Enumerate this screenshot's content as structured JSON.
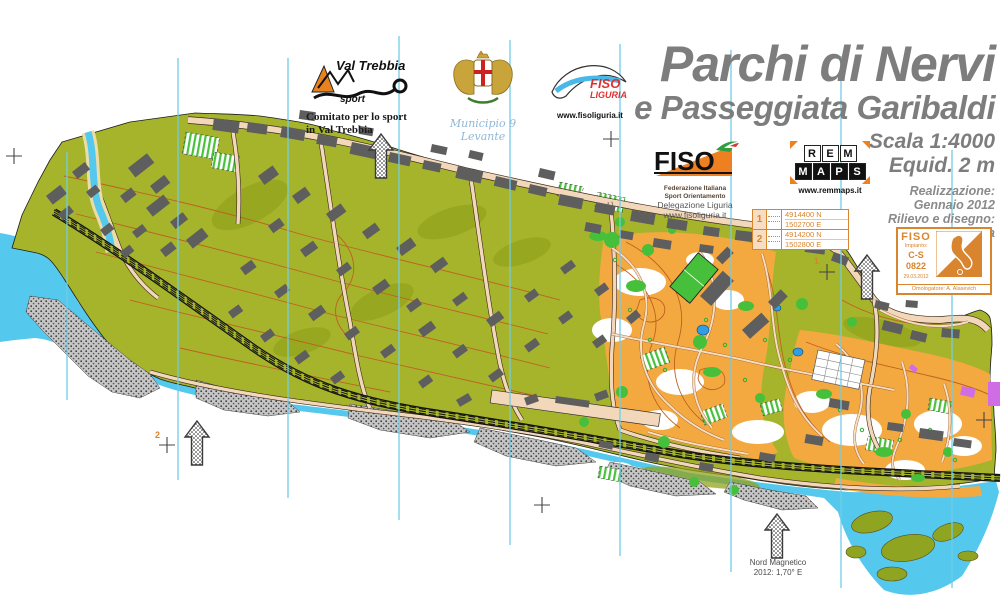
{
  "title": {
    "line1": "Parchi di Nervi",
    "line2": "e Passeggiata Garibaldi",
    "scale": "Scala 1:4000",
    "equidistance": "Equid. 2 m"
  },
  "credits": {
    "line1": "Realizzazione:",
    "line2": "Gennaio 2012",
    "line3": "Rilievo e disegno:",
    "line4": "Remo Madella"
  },
  "logos": {
    "val_trebbia": {
      "name": "Val Trebbia",
      "sub": "sport",
      "caption_line1": "Comitato per lo sport",
      "caption_line2": "in Val Trebbia"
    },
    "municipio": {
      "caption": "Municipio 9 Levante"
    },
    "fiso_liguria": {
      "line1": "FISO",
      "line2": "LIGURIA",
      "url": "www.fisoliguria.it"
    },
    "fiso_delegazione": {
      "acronym": "FISO",
      "sub1": "Federazione Italiana",
      "sub2": "Sport Orientamento",
      "sub3": "Delegazione Liguria",
      "url": "www.fisoliguria.it"
    },
    "remmaps": {
      "row1": [
        "R",
        "E",
        "M"
      ],
      "row2": [
        "M",
        "A",
        "P",
        "S"
      ],
      "url": "www.remmaps.it"
    }
  },
  "georef": {
    "rows": [
      {
        "id": "1",
        "north": "4914400 N",
        "east": "1502700 E"
      },
      {
        "id": "2",
        "north": "4914200 N",
        "east": "1502800 E"
      }
    ]
  },
  "stamp": {
    "federation": "FISO",
    "label": "Impianto:",
    "code_line1": "C-S",
    "code_line2": "0822",
    "date": "29.03.2012",
    "approver": "Omologatore: A. Alasevich"
  },
  "map": {
    "north_label_line1": "Nord Magnetico",
    "north_label_line2": "2012: 1,70° E",
    "marker1": "1",
    "marker2": "2"
  },
  "colors": {
    "olive_green": "#a6b42c",
    "park_orange": "#f4a940",
    "sea_cyan": "#55c8ee",
    "veg_green": "#46c03a",
    "building_gray": "#5e5e5e",
    "road_tan": "#f2d7bb",
    "contour_brown": "#c06020",
    "north_line_blue": "#70cce6",
    "accent_orange": "#d9842e",
    "title_gray": "#7d7d7d"
  }
}
